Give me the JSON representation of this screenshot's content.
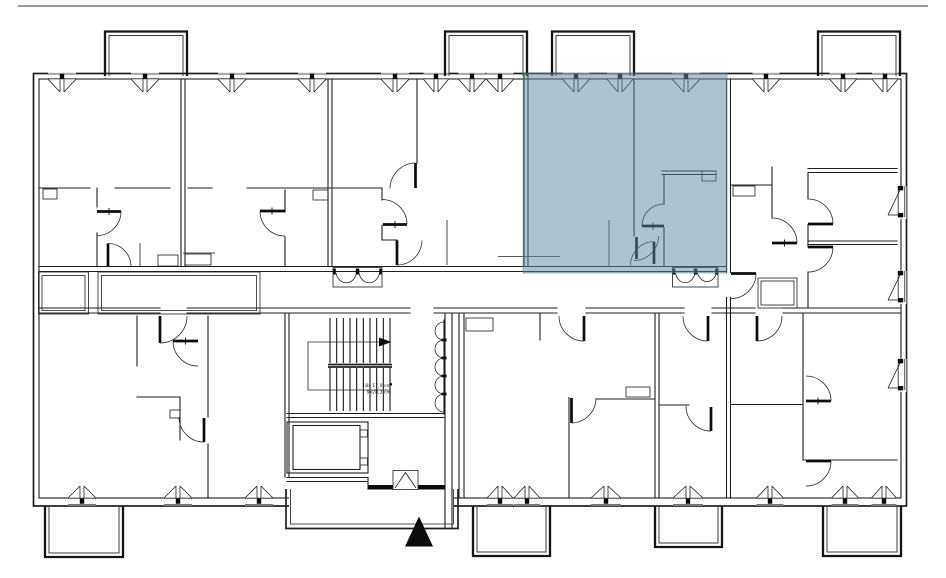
{
  "meta": {
    "description": "Architectural floor plan of an apartment building level with one unit highlighted",
    "canvas": {
      "width": 946,
      "height": 578
    }
  },
  "theme": {
    "background": "#ffffff",
    "line_color": "#1f1f1f",
    "rule_color": "#9b9b9b",
    "highlight_fill": "rgba(95,135,157,0.5)",
    "highlight_edge": "rgba(74,106,125,0.45)"
  },
  "floor_plan": {
    "highlighted_unit": {
      "x": 523,
      "y": 73,
      "width": 204,
      "height": 200
    },
    "stairs": {
      "label_line1": "18x 17,0 cm",
      "label_line2": "9x28,3 cm"
    },
    "windows": {
      "top": [
        [
          62,
          28
        ],
        [
          145,
          28
        ],
        [
          232,
          28
        ],
        [
          312,
          28
        ],
        [
          395,
          28
        ],
        [
          436,
          25
        ],
        [
          472,
          27
        ],
        [
          500,
          27
        ],
        [
          576,
          27
        ],
        [
          620,
          26
        ],
        [
          686,
          28
        ],
        [
          766,
          27
        ],
        [
          843,
          27
        ],
        [
          885,
          26
        ]
      ],
      "bottom": [
        [
          82,
          28
        ],
        [
          178,
          28
        ],
        [
          259,
          28
        ],
        [
          500,
          26
        ],
        [
          527,
          26
        ],
        [
          606,
          30
        ],
        [
          688,
          30
        ],
        [
          770,
          27
        ],
        [
          845,
          27
        ],
        [
          884,
          25
        ]
      ],
      "right": [
        [
          188,
          215
        ],
        [
          273,
          300
        ],
        [
          361,
          388
        ]
      ]
    },
    "balconies": {
      "top": [
        [
          105,
          187
        ],
        [
          445,
          527
        ],
        [
          552,
          634
        ],
        [
          818,
          900
        ]
      ],
      "bottom": [
        [
          45,
          123,
          557
        ],
        [
          473,
          550,
          556
        ],
        [
          655,
          722,
          547
        ],
        [
          823,
          901,
          556
        ]
      ]
    },
    "stair_treads": {
      "x_start": 330,
      "x_end": 390,
      "count": 10,
      "upper_y": [
        318,
        363
      ],
      "lower_y": [
        368,
        411
      ]
    },
    "scallops": {
      "x": 444,
      "y_start": 322,
      "count": 5,
      "radius": 9
    }
  }
}
